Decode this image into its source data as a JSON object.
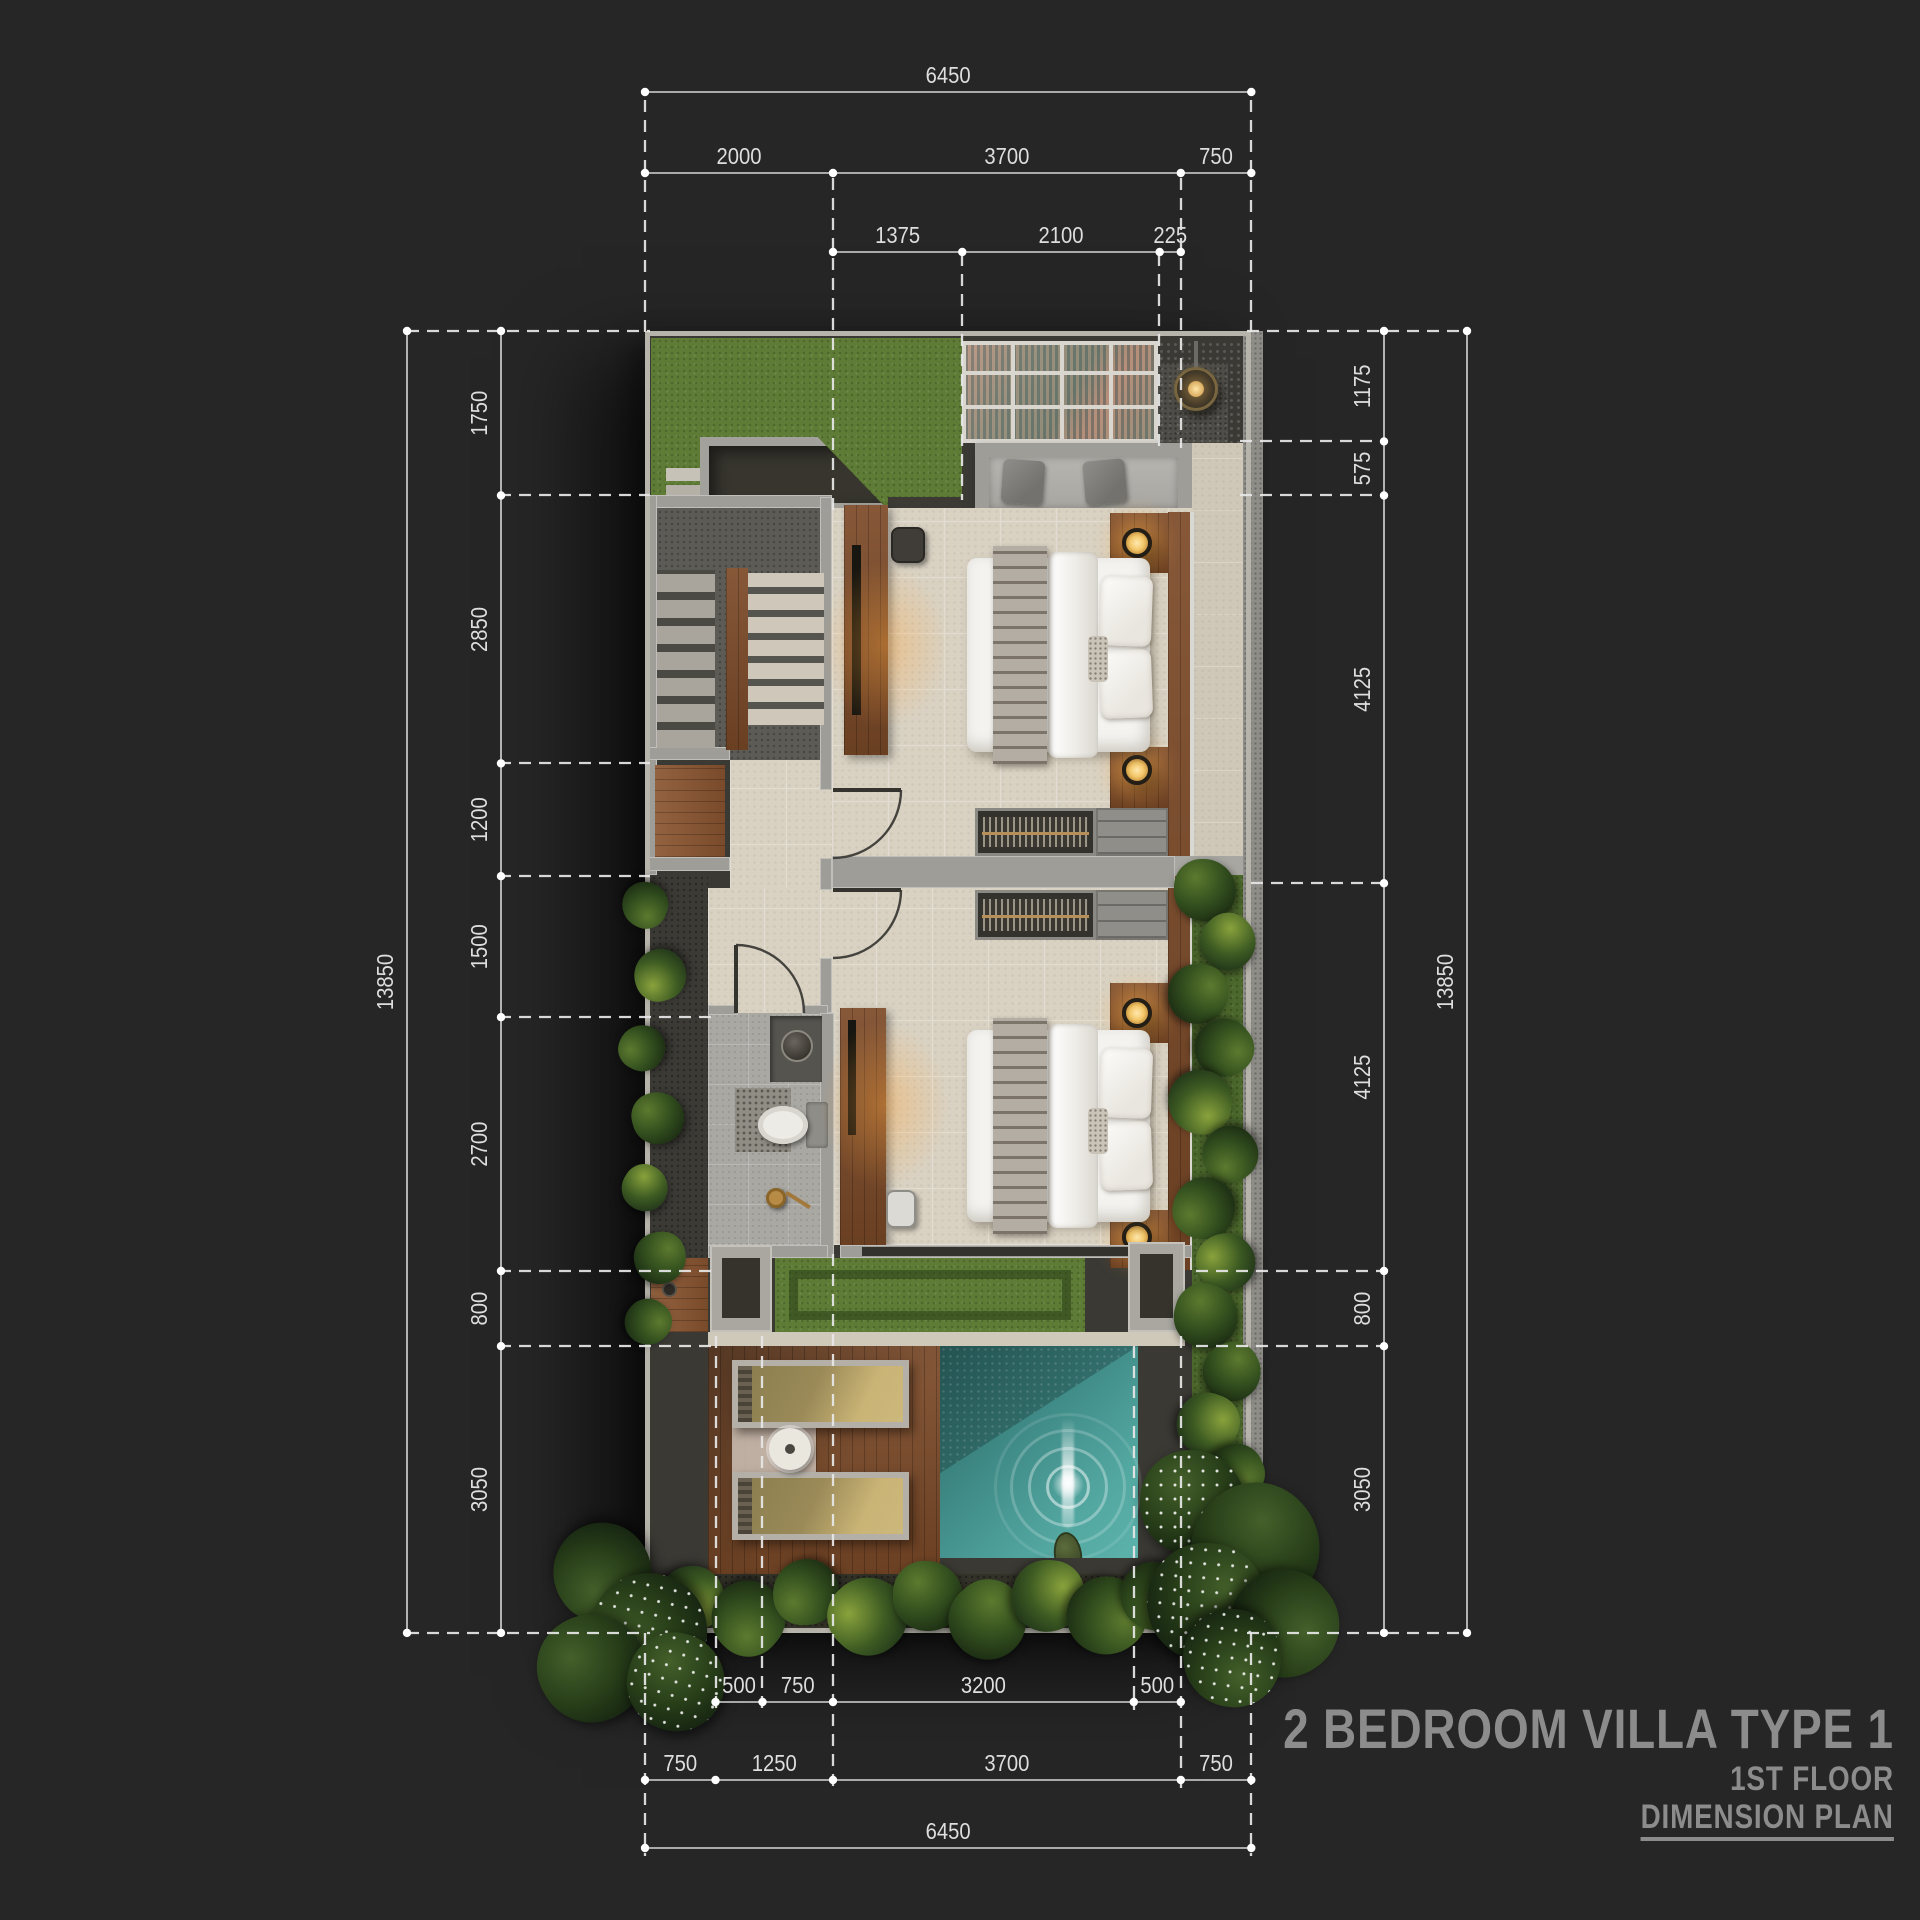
{
  "title_block": {
    "project": "2 BEDROOM VILLA TYPE 1",
    "floor": "1ST FLOOR",
    "sheet": "DIMENSION PLAN"
  },
  "dimensions": {
    "top_rows": [
      {
        "name": "overall-width",
        "values": [
          "6450"
        ],
        "start_mm": 0
      },
      {
        "name": "front-segments",
        "values": [
          "2000",
          "3700",
          "750"
        ],
        "start_mm": 0
      },
      {
        "name": "entry-segments",
        "values": [
          "1375",
          "2100",
          "225"
        ],
        "start_mm": 2000
      }
    ],
    "bottom_rows": [
      {
        "name": "pool-deck-segments",
        "values": [
          "500",
          "750",
          "3200",
          "500"
        ],
        "start_mm": 750
      },
      {
        "name": "rear-segments",
        "values": [
          "750",
          "1250",
          "3700",
          "750"
        ],
        "start_mm": 0
      },
      {
        "name": "overall-width-bottom",
        "values": [
          "6450"
        ],
        "start_mm": 0
      }
    ],
    "left_cols": [
      {
        "name": "overall-depth-left",
        "values": [
          "13850"
        ],
        "start_mm": 0
      },
      {
        "name": "left-segments",
        "values": [
          "1750",
          "2850",
          "1200",
          "1500",
          "2700",
          "800",
          "3050"
        ],
        "start_mm": 0
      }
    ],
    "right_cols": [
      {
        "name": "right-segments",
        "values": [
          "1175",
          "575",
          "4125",
          "4125",
          "800",
          "3050"
        ],
        "start_mm": 0
      },
      {
        "name": "overall-depth-right",
        "values": [
          "13850"
        ],
        "start_mm": 0
      }
    ]
  },
  "colors": {
    "background": "#262626",
    "dimension_line": "#d6d6d6",
    "dimension_text": "#dedede",
    "title_text": "#8c8c8c",
    "grass": "#5e7c35",
    "floor_travertine": "#d9d2c3",
    "wall": "#9e9d98",
    "wood": "#7c4a28",
    "pool_water": "#4b9c98",
    "glass_roof": "#8fc3bd"
  }
}
